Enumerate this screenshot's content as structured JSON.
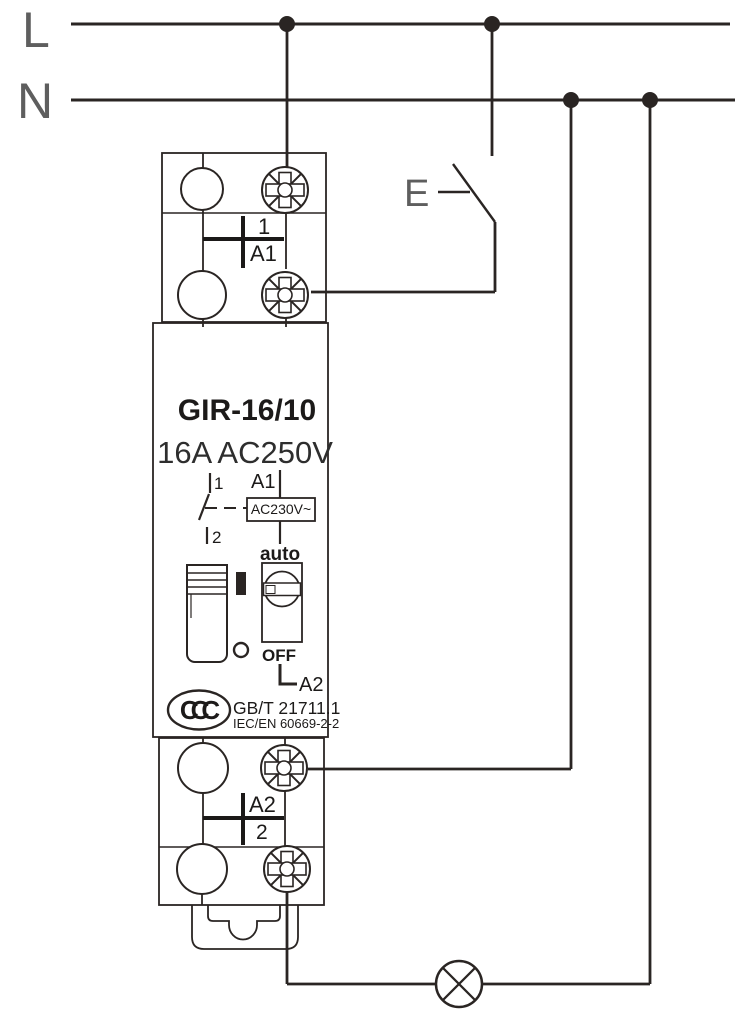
{
  "colors": {
    "ink": "#2a2523",
    "label_gray": "#5e5e5e",
    "text_black": "#1c1a19",
    "rating_gray": "#2e2e2e",
    "background": "#ffffff"
  },
  "rails": {
    "line": "L",
    "neutral": "N"
  },
  "pushbutton": {
    "label": "E"
  },
  "device": {
    "model": "GIR-16/10",
    "rating": "16A AC250V",
    "top_block": {
      "terminal_contact": "1",
      "terminal_coil": "A1"
    },
    "schematic": {
      "contact_in": "1",
      "contact_out": "2",
      "coil_terminal": "A1",
      "coil_rating": "AC230V~",
      "mode_auto": "auto",
      "mode_off": "OFF",
      "coil_return": "A2"
    },
    "approvals": {
      "ccc": "CCC",
      "gb_standard": "GB/T 21711.1",
      "iec_standard": "IEC/EN 60669-2-2"
    },
    "bottom_block": {
      "terminal_coil_return": "A2",
      "terminal_contact": "2"
    }
  }
}
